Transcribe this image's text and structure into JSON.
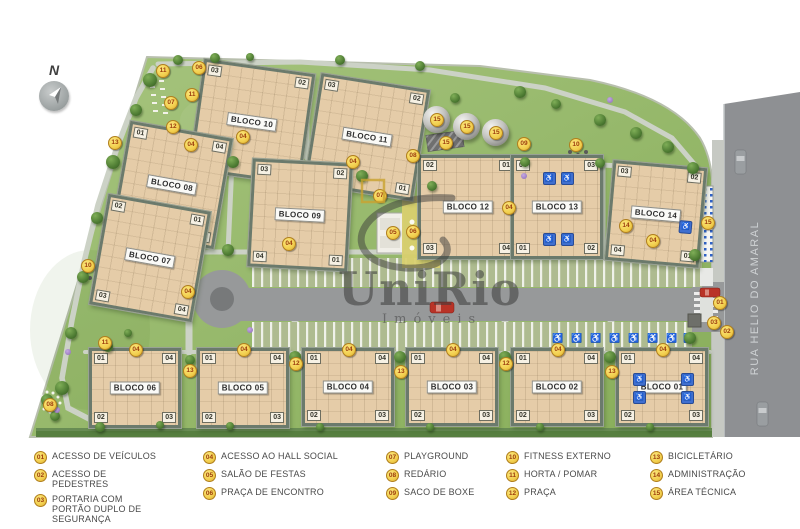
{
  "map": {
    "compass_label": "N",
    "street_name": "RUA HELIO DO AMARAL",
    "watermark": {
      "brand": "UniRio",
      "sub": "Imóveis"
    },
    "colors": {
      "grass": "#94b868",
      "building": "#e5cca8",
      "road": "#97999a",
      "marker_bg": "#f2cf4e",
      "marker_text": "#9c3c0c",
      "accessible_blue": "#3f6fd0"
    },
    "blocks": [
      {
        "label": "BLOCO 10",
        "x": 196,
        "y": 66,
        "w": 112,
        "h": 112,
        "rot": 8,
        "units": [
          "03",
          "02",
          "04",
          "01"
        ],
        "acc": []
      },
      {
        "label": "BLOCO 11",
        "x": 312,
        "y": 81,
        "w": 110,
        "h": 112,
        "rot": 9,
        "units": [
          "03",
          "02",
          "04",
          "01"
        ],
        "acc": []
      },
      {
        "label": "BLOCO 08",
        "x": 120,
        "y": 129,
        "w": 104,
        "h": 112,
        "rot": 10,
        "units": [
          "01",
          "04",
          "02",
          "03"
        ],
        "acc": []
      },
      {
        "label": "BLOCO 07",
        "x": 98,
        "y": 202,
        "w": 104,
        "h": 112,
        "rot": 10,
        "units": [
          "02",
          "01",
          "03",
          "04"
        ],
        "acc": []
      },
      {
        "label": "BLOCO 09",
        "x": 250,
        "y": 161,
        "w": 100,
        "h": 108,
        "rot": 3,
        "units": [
          "03",
          "02",
          "04",
          "01"
        ],
        "acc": []
      },
      {
        "label": "BLOCO 12",
        "x": 418,
        "y": 155,
        "w": 100,
        "h": 104,
        "rot": 0,
        "units": [
          "02",
          "01",
          "03",
          "04"
        ],
        "acc": []
      },
      {
        "label": "BLOCO 13",
        "x": 511,
        "y": 155,
        "w": 92,
        "h": 104,
        "rot": 0,
        "units": [
          "04",
          "03",
          "01",
          "02"
        ],
        "acc": [
          [
            0.39,
            0.19
          ],
          [
            0.6,
            0.19
          ],
          [
            0.39,
            0.82
          ],
          [
            0.6,
            0.82
          ]
        ]
      },
      {
        "label": "BLOCO 14",
        "x": 609,
        "y": 164,
        "w": 94,
        "h": 100,
        "rot": 5,
        "units": [
          "03",
          "02",
          "04",
          "01"
        ],
        "acc": [
          [
            0.83,
            0.6
          ]
        ]
      },
      {
        "label": "BLOCO 06",
        "x": 89,
        "y": 348,
        "w": 92,
        "h": 80,
        "rot": 0,
        "units": [
          "01",
          "04",
          "02",
          "03"
        ],
        "acc": []
      },
      {
        "label": "BLOCO 05",
        "x": 197,
        "y": 348,
        "w": 92,
        "h": 80,
        "rot": 0,
        "units": [
          "01",
          "04",
          "02",
          "03"
        ],
        "acc": []
      },
      {
        "label": "BLOCO 04",
        "x": 302,
        "y": 348,
        "w": 92,
        "h": 78,
        "rot": 0,
        "units": [
          "01",
          "04",
          "02",
          "03"
        ],
        "acc": []
      },
      {
        "label": "BLOCO 03",
        "x": 406,
        "y": 348,
        "w": 92,
        "h": 78,
        "rot": 0,
        "units": [
          "01",
          "04",
          "02",
          "03"
        ],
        "acc": []
      },
      {
        "label": "BLOCO 02",
        "x": 511,
        "y": 348,
        "w": 92,
        "h": 78,
        "rot": 0,
        "units": [
          "01",
          "04",
          "02",
          "03"
        ],
        "acc": []
      },
      {
        "label": "BLOCO 01",
        "x": 616,
        "y": 348,
        "w": 92,
        "h": 78,
        "rot": 0,
        "units": [
          "01",
          "04",
          "02",
          "03"
        ],
        "acc": [
          [
            0.22,
            0.38
          ],
          [
            0.78,
            0.38
          ],
          [
            0.22,
            0.63
          ],
          [
            0.78,
            0.63
          ]
        ]
      }
    ],
    "markers": [
      {
        "n": "06",
        "x": 198,
        "y": 67
      },
      {
        "n": "11",
        "x": 162,
        "y": 70
      },
      {
        "n": "11",
        "x": 191,
        "y": 94
      },
      {
        "n": "07",
        "x": 170,
        "y": 102
      },
      {
        "n": "12",
        "x": 172,
        "y": 126
      },
      {
        "n": "13",
        "x": 114,
        "y": 142
      },
      {
        "n": "04",
        "x": 190,
        "y": 144
      },
      {
        "n": "04",
        "x": 242,
        "y": 136
      },
      {
        "n": "04",
        "x": 352,
        "y": 161
      },
      {
        "n": "15",
        "x": 436,
        "y": 119
      },
      {
        "n": "15",
        "x": 466,
        "y": 126
      },
      {
        "n": "15",
        "x": 495,
        "y": 132
      },
      {
        "n": "15",
        "x": 445,
        "y": 142
      },
      {
        "n": "08",
        "x": 412,
        "y": 155
      },
      {
        "n": "09",
        "x": 523,
        "y": 143
      },
      {
        "n": "10",
        "x": 575,
        "y": 144
      },
      {
        "n": "07",
        "x": 379,
        "y": 195
      },
      {
        "n": "05",
        "x": 392,
        "y": 232
      },
      {
        "n": "06",
        "x": 412,
        "y": 231
      },
      {
        "n": "04",
        "x": 288,
        "y": 243
      },
      {
        "n": "04",
        "x": 508,
        "y": 207
      },
      {
        "n": "14",
        "x": 625,
        "y": 225
      },
      {
        "n": "04",
        "x": 652,
        "y": 240
      },
      {
        "n": "04",
        "x": 187,
        "y": 291
      },
      {
        "n": "10",
        "x": 87,
        "y": 265
      },
      {
        "n": "15",
        "x": 707,
        "y": 222
      },
      {
        "n": "01",
        "x": 719,
        "y": 302
      },
      {
        "n": "03",
        "x": 713,
        "y": 322
      },
      {
        "n": "02",
        "x": 726,
        "y": 331
      },
      {
        "n": "11",
        "x": 104,
        "y": 342
      },
      {
        "n": "08",
        "x": 49,
        "y": 404
      },
      {
        "n": "12",
        "x": 295,
        "y": 363
      },
      {
        "n": "12",
        "x": 505,
        "y": 363
      },
      {
        "n": "13",
        "x": 189,
        "y": 370
      },
      {
        "n": "13",
        "x": 400,
        "y": 371
      },
      {
        "n": "13",
        "x": 611,
        "y": 371
      },
      {
        "n": "04",
        "x": 135,
        "y": 349
      },
      {
        "n": "04",
        "x": 243,
        "y": 349
      },
      {
        "n": "04",
        "x": 348,
        "y": 349
      },
      {
        "n": "04",
        "x": 452,
        "y": 349
      },
      {
        "n": "04",
        "x": 557,
        "y": 349
      },
      {
        "n": "04",
        "x": 662,
        "y": 349
      }
    ],
    "domes": [
      [
        436,
        119
      ],
      [
        466,
        126
      ],
      [
        495,
        132
      ]
    ],
    "trees": [
      [
        150,
        80,
        7
      ],
      [
        136,
        110,
        6
      ],
      [
        113,
        162,
        7
      ],
      [
        97,
        218,
        6
      ],
      [
        83,
        277,
        6
      ],
      [
        71,
        333,
        6
      ],
      [
        62,
        388,
        7
      ],
      [
        47,
        400,
        6
      ],
      [
        178,
        60,
        5
      ],
      [
        215,
        58,
        5
      ],
      [
        250,
        57,
        4
      ],
      [
        340,
        60,
        5
      ],
      [
        420,
        66,
        5
      ],
      [
        455,
        98,
        5
      ],
      [
        520,
        92,
        6
      ],
      [
        556,
        104,
        5
      ],
      [
        600,
        120,
        6
      ],
      [
        636,
        133,
        6
      ],
      [
        668,
        147,
        6
      ],
      [
        233,
        162,
        6
      ],
      [
        228,
        250,
        6
      ],
      [
        362,
        176,
        6
      ],
      [
        432,
        186,
        5
      ],
      [
        525,
        162,
        5
      ],
      [
        600,
        163,
        5
      ],
      [
        693,
        168,
        6
      ],
      [
        695,
        255,
        6
      ],
      [
        690,
        338,
        6
      ],
      [
        190,
        360,
        5
      ],
      [
        295,
        357,
        6
      ],
      [
        400,
        357,
        6
      ],
      [
        505,
        357,
        6
      ],
      [
        610,
        357,
        6
      ],
      [
        108,
        347,
        5
      ],
      [
        128,
        333,
        4
      ],
      [
        55,
        416,
        5
      ],
      [
        100,
        427,
        5
      ],
      [
        160,
        425,
        4
      ],
      [
        230,
        426,
        4
      ],
      [
        320,
        427,
        4
      ],
      [
        430,
        427,
        4
      ],
      [
        540,
        427,
        4
      ],
      [
        650,
        427,
        4
      ]
    ],
    "flowers": [
      [
        68,
        352
      ],
      [
        57,
        410
      ],
      [
        610,
        100
      ],
      [
        524,
        176
      ],
      [
        250,
        330
      ]
    ]
  },
  "legend": {
    "items": [
      {
        "num": "01",
        "label": "ACESSO DE VEÍCULOS"
      },
      {
        "num": "02",
        "label": "ACESSO DE PEDESTRES"
      },
      {
        "num": "03",
        "label": "PORTARIA COM PORTÃO DUPLO DE SEGURANÇA"
      },
      {
        "num": "04",
        "label": "ACESSO AO HALL SOCIAL"
      },
      {
        "num": "05",
        "label": "SALÃO DE FESTAS"
      },
      {
        "num": "06",
        "label": "PRAÇA DE ENCONTRO"
      },
      {
        "num": "07",
        "label": "PLAYGROUND"
      },
      {
        "num": "08",
        "label": "REDÁRIO"
      },
      {
        "num": "09",
        "label": "SACO DE BOXE"
      },
      {
        "num": "10",
        "label": "FITNESS EXTERNO"
      },
      {
        "num": "11",
        "label": "HORTA / POMAR"
      },
      {
        "num": "12",
        "label": "PRAÇA"
      },
      {
        "num": "13",
        "label": "BICICLETÁRIO"
      },
      {
        "num": "14",
        "label": "ADMINISTRAÇÃO"
      },
      {
        "num": "15",
        "label": "ÁREA TÉCNICA"
      }
    ]
  }
}
